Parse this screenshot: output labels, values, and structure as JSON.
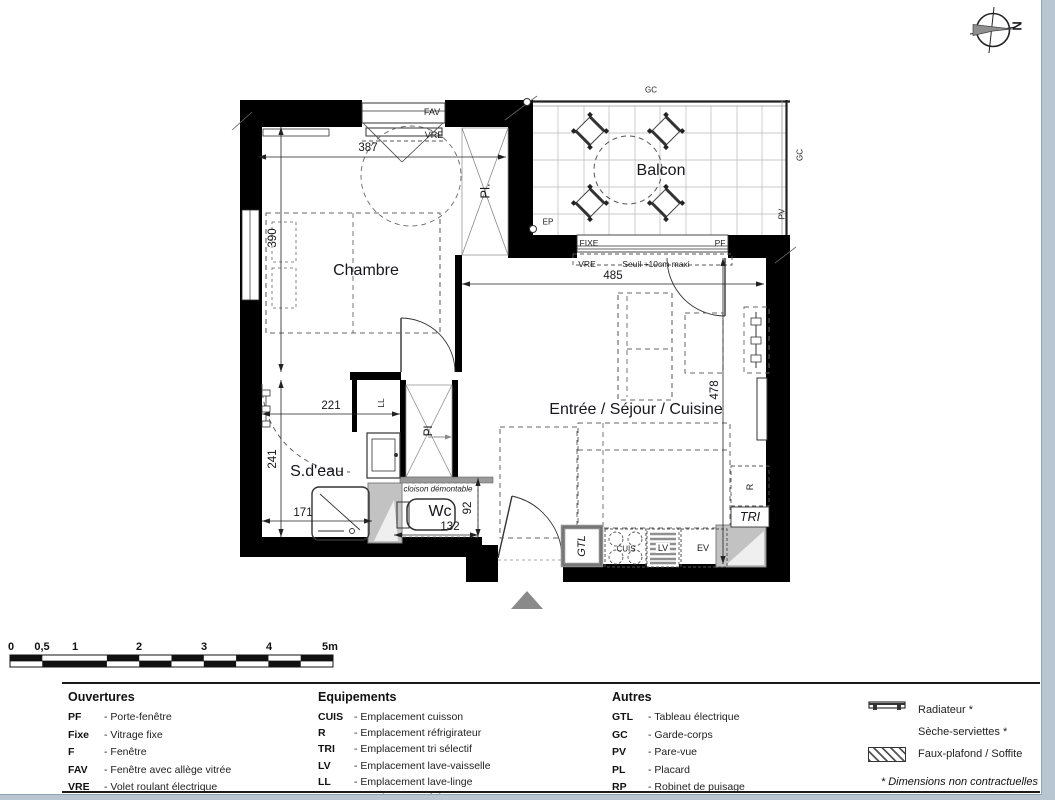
{
  "compass": {
    "north": "N"
  },
  "plan": {
    "rooms": {
      "bedroom": "Chambre",
      "balcony": "Balcon",
      "living": "Entrée / Séjour / Cuisine",
      "shower_room": "S.d'eau",
      "wc": "Wc"
    },
    "dims": {
      "bedroom_width": "387",
      "bedroom_depth": "390",
      "living_width": "485",
      "living_depth": "478",
      "shower_width": "221",
      "shower_depth": "241",
      "shower_inner_width": "171",
      "wc_width": "132",
      "wc_depth": "92"
    },
    "annotations": {
      "fav": "FAV",
      "vre_bedroom": "VRE",
      "closet_upper": "Pl.",
      "closet_lower": "Pl",
      "washer": "LL",
      "ep": "EP",
      "gc_top": "GC",
      "gc_right": "GC",
      "pv": "PV",
      "fixe": "FIXE",
      "pf": "PF",
      "vre_living": "VRE",
      "seuil": "Seuil +10cm maxi",
      "cloison": "cloison démontable",
      "gtl": "GTL",
      "cuis": "CUIS",
      "lv": "LV",
      "ev": "EV",
      "fridge": "R",
      "tri": "TRI"
    }
  },
  "scalebar": {
    "ticks": [
      "0",
      "0,5",
      "1",
      "2",
      "3",
      "4",
      "5m"
    ]
  },
  "legend": {
    "ouvertures": {
      "title": "Ouvertures",
      "items": [
        {
          "abbr": "PF",
          "desc": "- Porte-fenêtre"
        },
        {
          "abbr": "Fixe",
          "desc": "- Vitrage fixe"
        },
        {
          "abbr": "F",
          "desc": "- Fenêtre"
        },
        {
          "abbr": "FAV",
          "desc": "- Fenêtre avec allège vitrée"
        },
        {
          "abbr": "VRE",
          "desc": "- Volet roulant électrique"
        }
      ]
    },
    "equipements": {
      "title": "Equipements",
      "items": [
        {
          "abbr": "CUIS",
          "desc": "- Emplacement cuisson"
        },
        {
          "abbr": "R",
          "desc": "- Emplacement réfrigirateur"
        },
        {
          "abbr": "TRI",
          "desc": "- Emplacement tri sélectif"
        },
        {
          "abbr": "LV",
          "desc": "- Emplacement lave-vaisselle"
        },
        {
          "abbr": "LL",
          "desc": "- Emplacement lave-linge"
        },
        {
          "abbr": "EV",
          "desc": "- Emplacement évier"
        },
        {
          "abbr": "LC",
          "desc": "- Emplacement linéaire complémentaire"
        }
      ]
    },
    "autres": {
      "title": "Autres",
      "items": [
        {
          "abbr": "GTL",
          "desc": "- Tableau électrique"
        },
        {
          "abbr": "GC",
          "desc": "- Garde-corps"
        },
        {
          "abbr": "PV",
          "desc": "- Pare-vue"
        },
        {
          "abbr": "PL",
          "desc": "- Placard"
        },
        {
          "abbr": "RP",
          "desc": "- Robinet de puisage"
        }
      ]
    },
    "symbols": {
      "items": [
        {
          "label": "Radiateur *"
        },
        {
          "label": "Sèche-serviettes *"
        },
        {
          "label": "Faux-plafond / Soffite"
        }
      ],
      "footnote": "* Dimensions non contractuelles"
    }
  }
}
